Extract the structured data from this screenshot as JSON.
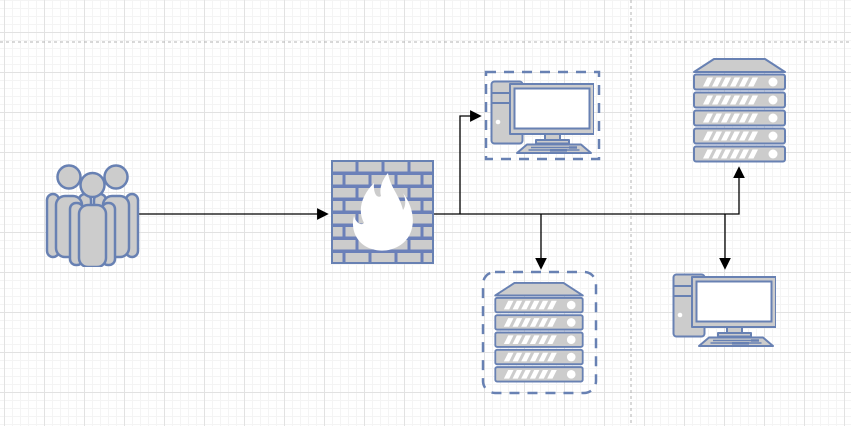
{
  "app": {
    "name": "diagram-canvas",
    "description": "network diagram on gridded drawing canvas"
  },
  "palette": {
    "shape_fill": "#cccccc",
    "shape_stroke": "#6881b3",
    "firewall_mortar": "#6b80b9",
    "highlight_white": "#ffffff",
    "grid_minor": "#f4f4f4",
    "grid_major": "#e2e2e2",
    "canvas_background": "#ffffff"
  },
  "connector": {
    "color": "#000000",
    "width": 1.3,
    "arrowhead": "filled-triangle"
  },
  "page_breaks": {
    "color": "#b3b3b3",
    "lines": [
      {
        "x1": 0,
        "y1": 42,
        "x2": 851,
        "y2": 42
      },
      {
        "x1": 631,
        "y1": 0,
        "x2": 631,
        "y2": 426
      }
    ]
  },
  "nodes": [
    {
      "id": "users",
      "type": "users",
      "label": "",
      "x": 45,
      "y": 163,
      "w": 95,
      "h": 104
    },
    {
      "id": "firewall",
      "type": "firewall",
      "label": "",
      "x": 331,
      "y": 160,
      "w": 103,
      "h": 104
    },
    {
      "id": "pc-top",
      "type": "desktop",
      "label": "",
      "x": 490,
      "y": 79,
      "w": 104,
      "h": 75,
      "container": {
        "x": 486,
        "y": 72,
        "w": 113,
        "h": 87,
        "rounded": false
      }
    },
    {
      "id": "server-right",
      "type": "server",
      "label": "",
      "x": 693,
      "y": 58,
      "w": 93,
      "h": 105
    },
    {
      "id": "server-bottom",
      "type": "server",
      "label": "",
      "x": 493,
      "y": 282,
      "w": 92,
      "h": 101,
      "container": {
        "x": 483,
        "y": 272,
        "w": 113,
        "h": 121,
        "rounded": true
      }
    },
    {
      "id": "pc-bottom",
      "type": "desktop",
      "label": "",
      "x": 672,
      "y": 272,
      "w": 104,
      "h": 75
    }
  ],
  "edges": [
    {
      "from": "users",
      "to": "firewall",
      "points": [
        [
          139,
          214
        ],
        [
          327,
          214
        ]
      ]
    },
    {
      "from": "firewall",
      "to": "server-right",
      "points": [
        [
          434,
          214
        ],
        [
          739,
          214
        ],
        [
          739,
          168
        ]
      ]
    },
    {
      "from": "firewall",
      "to": "pc-top",
      "points": [
        [
          460,
          214
        ],
        [
          460,
          116
        ],
        [
          480,
          116
        ]
      ]
    },
    {
      "from": "firewall",
      "to": "server-bottom",
      "points": [
        [
          541,
          214
        ],
        [
          541,
          268
        ]
      ]
    },
    {
      "from": "firewall",
      "to": "pc-bottom",
      "points": [
        [
          725,
          214
        ],
        [
          725,
          268
        ]
      ]
    }
  ],
  "icons": {
    "users": "people-group-icon",
    "firewall": "firewall-brick-flame-icon",
    "desktop": "desktop-computer-icon",
    "server": "server-stack-icon"
  }
}
